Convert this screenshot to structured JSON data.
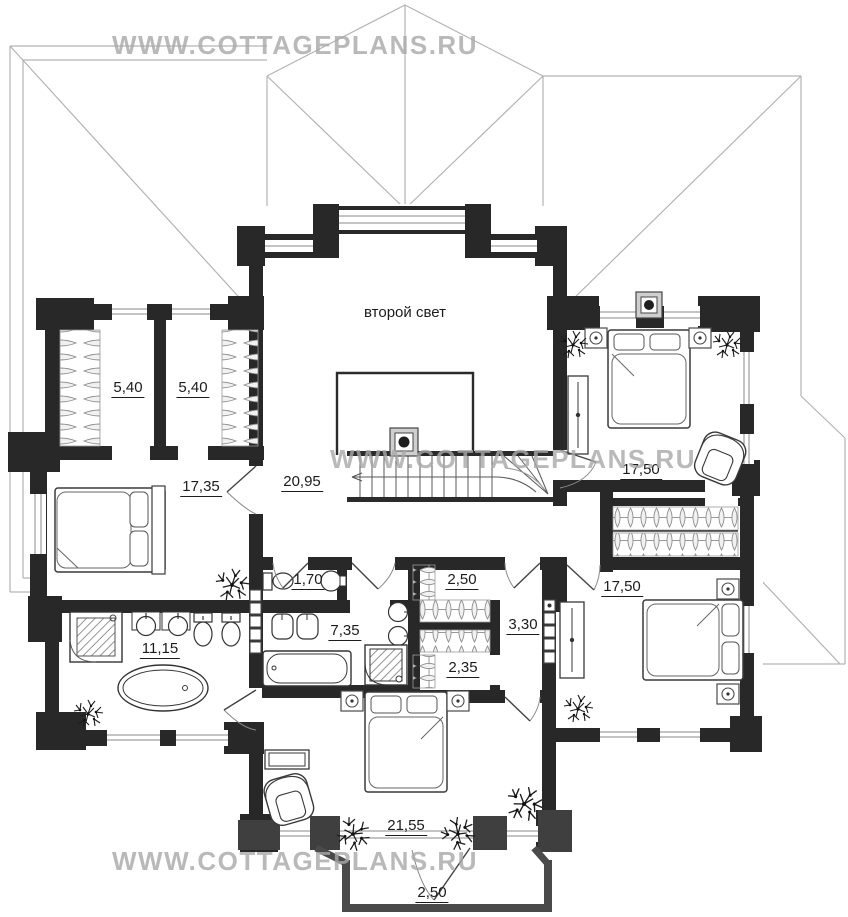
{
  "watermark": {
    "text": "WWW.COTTAGEPLANS.RU"
  },
  "labels": {
    "second_light": "второй свет",
    "closet_a": "5,40",
    "closet_b": "5,40",
    "bedroom_left": "17,35",
    "hall": "20,95",
    "bedroom_top_right": "17,50",
    "bedroom_bottom_right": "17,50",
    "wc": "1,70",
    "closet_top": "2,50",
    "corridor": "3,30",
    "bathroom_center": "7,35",
    "closet_bottom": "2,35",
    "bathroom_left": "11,15",
    "bedroom_bottom": "21,55",
    "balcony": "2,50"
  },
  "colors": {
    "wall": "#282828",
    "bay_wall": "#3f3f3f",
    "roof_line": "#b3b3b3",
    "watermark": "#a8a8a8",
    "label_text": "#1c1c1c"
  }
}
